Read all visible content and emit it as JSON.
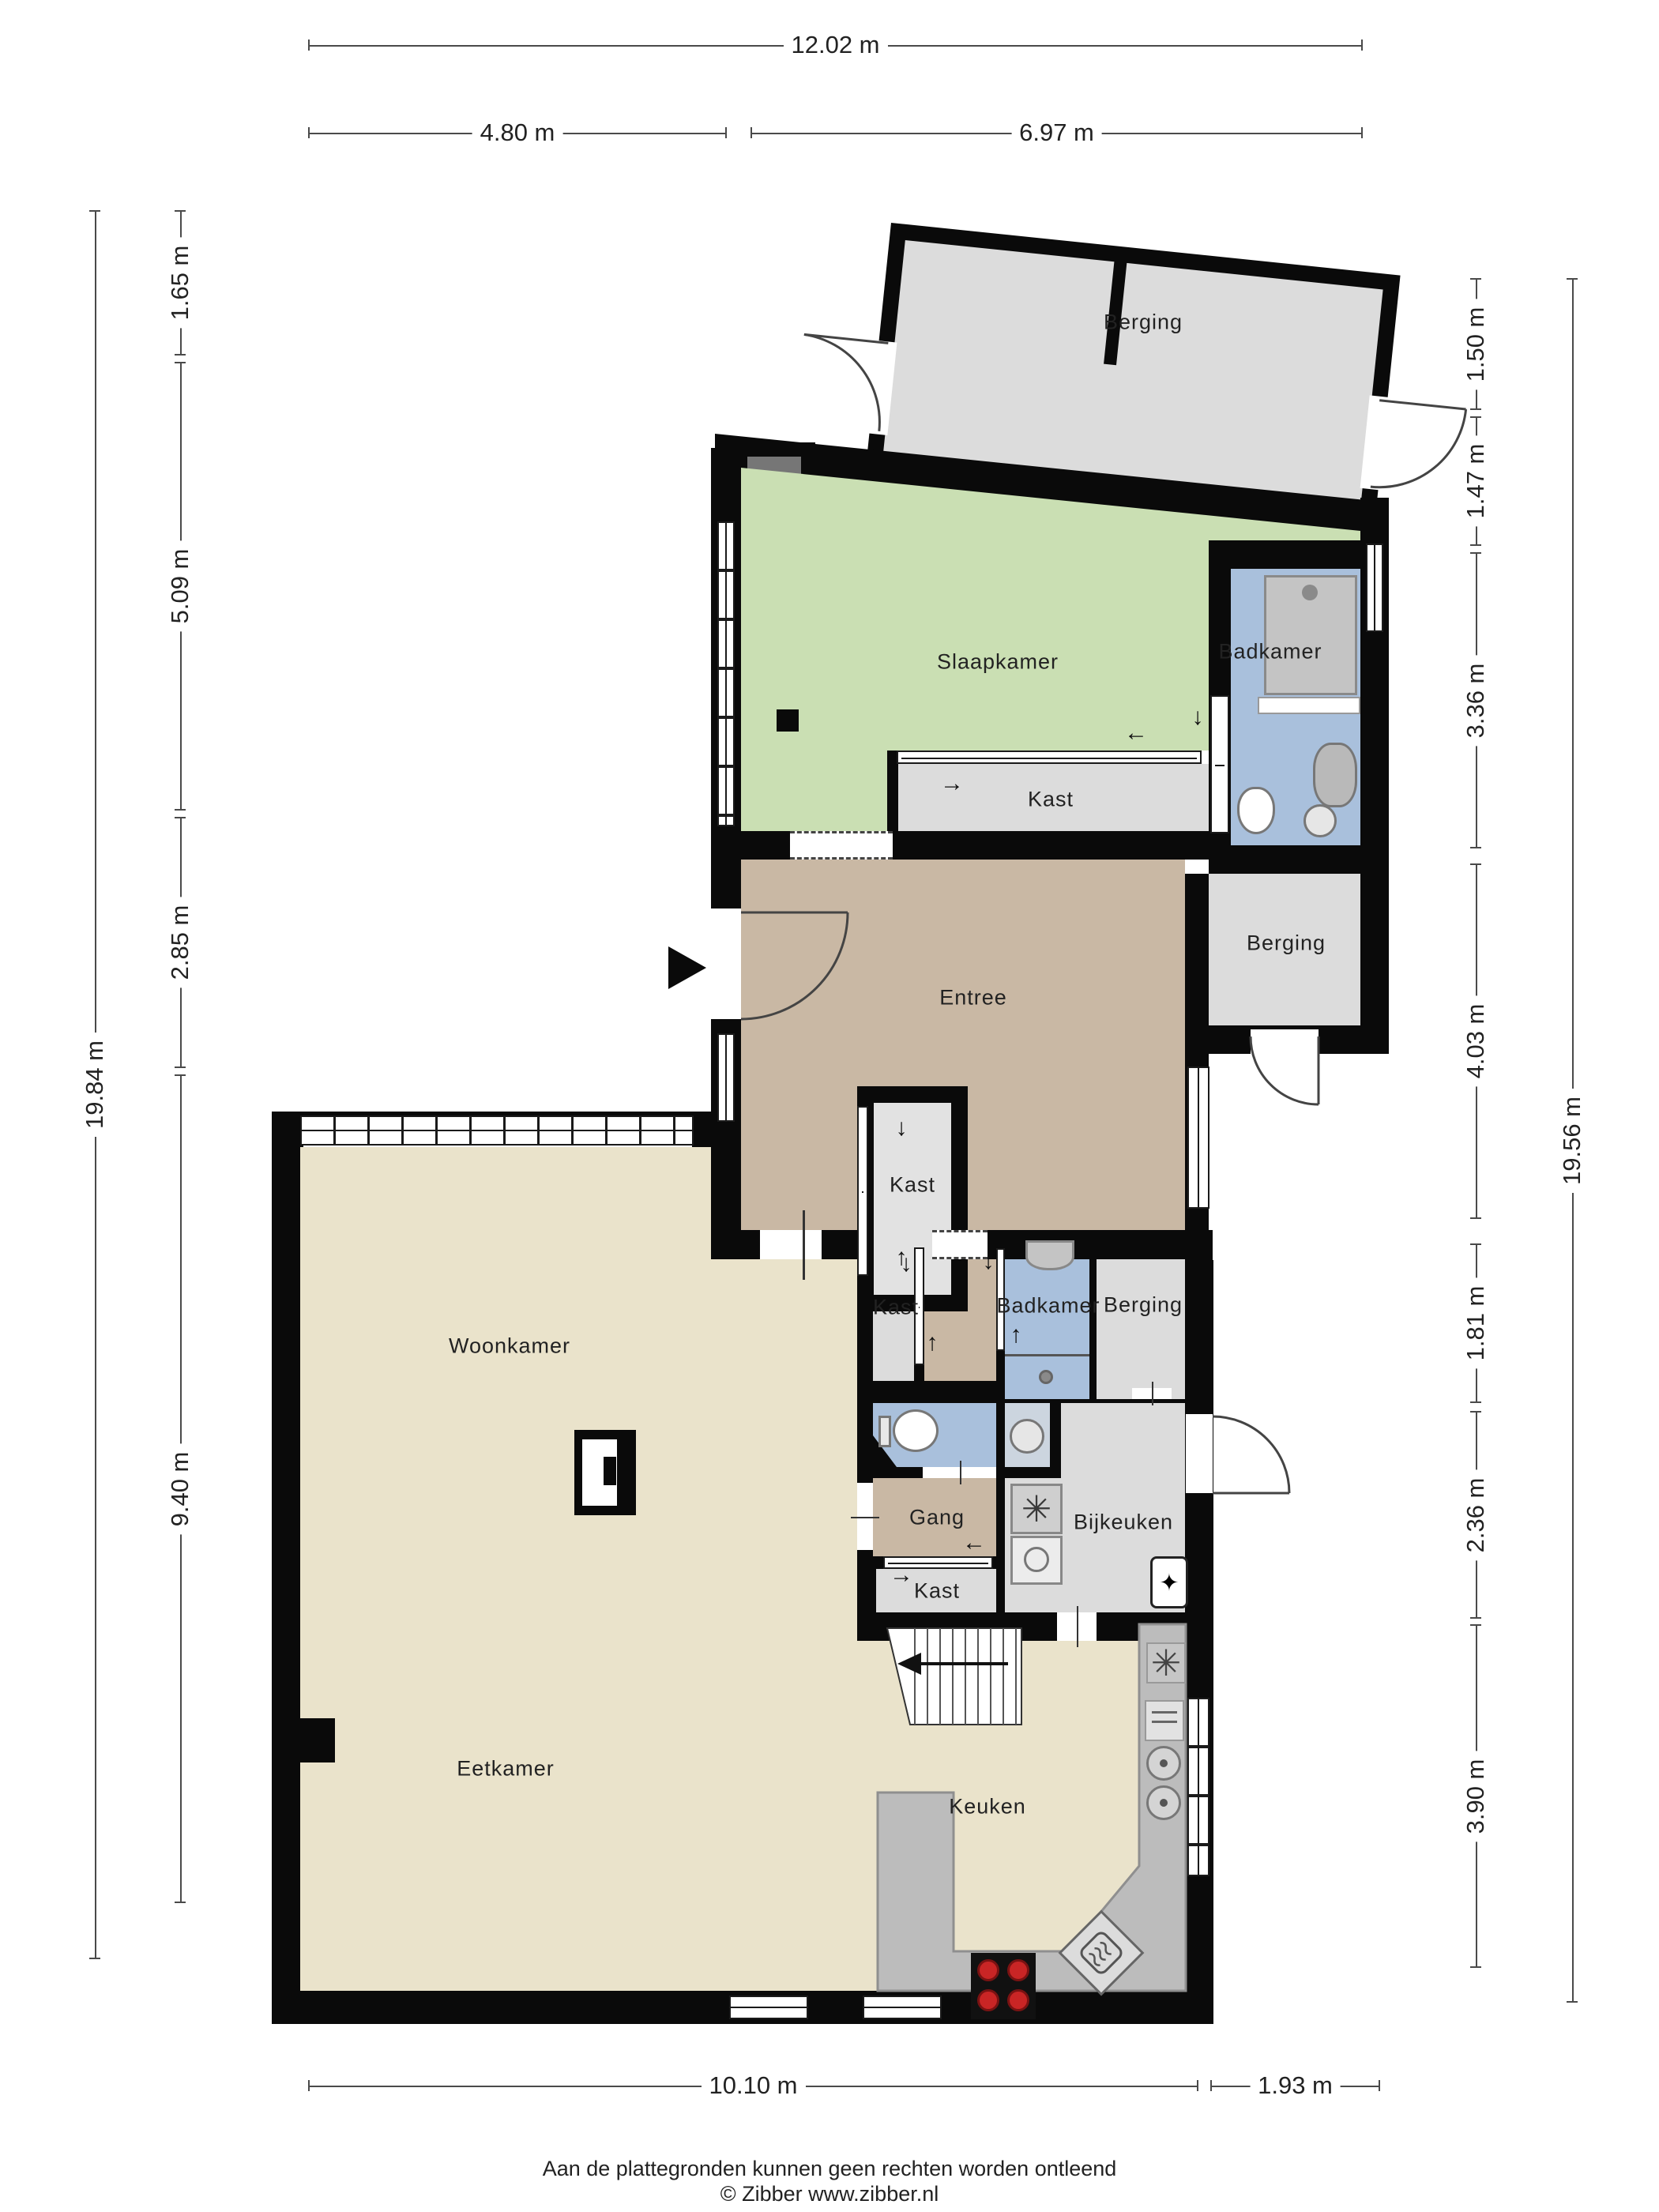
{
  "plan": {
    "rooms": {
      "berging_top": "Berging",
      "slaapkamer": "Slaapkamer",
      "badkamer_boven": "Badkamer",
      "kast_slaapkamer": "Kast",
      "berging_entree": "Berging",
      "entree": "Entree",
      "kast_entree": "Kast",
      "kast_midden": "Kast",
      "badkamer_beneden": "Badkamer",
      "berging_midden": "Berging",
      "gang": "Gang",
      "kast_gang": "Kast",
      "bijkeuken": "Bijkeuken",
      "woonkamer": "Woonkamer",
      "eetkamer": "Eetkamer",
      "keuken": "Keuken"
    },
    "dimensions": {
      "top_total": "12.02 m",
      "top_left": "4.80 m",
      "top_right": "6.97 m",
      "left_total": "19.84 m",
      "left_segments": [
        "1.65 m",
        "5.09 m",
        "2.85 m",
        "9.40 m"
      ],
      "right_total": "19.56 m",
      "right_segments": [
        "1.50 m",
        "1.47 m",
        "3.36 m",
        "4.03 m",
        "1.81 m",
        "2.36 m",
        "3.90 m"
      ],
      "bottom_left": "10.10 m",
      "bottom_right": "1.93 m"
    },
    "icons": {
      "fan": "✳",
      "flame": "✦",
      "arrow_down": "↓",
      "arrow_up": "↑",
      "arrow_left": "←",
      "arrow_right": "→"
    },
    "footer": {
      "disclaimer": "Aan de plattegronden kunnen geen rechten worden ontleend",
      "copyright": "© Zibber www.zibber.nl"
    }
  }
}
